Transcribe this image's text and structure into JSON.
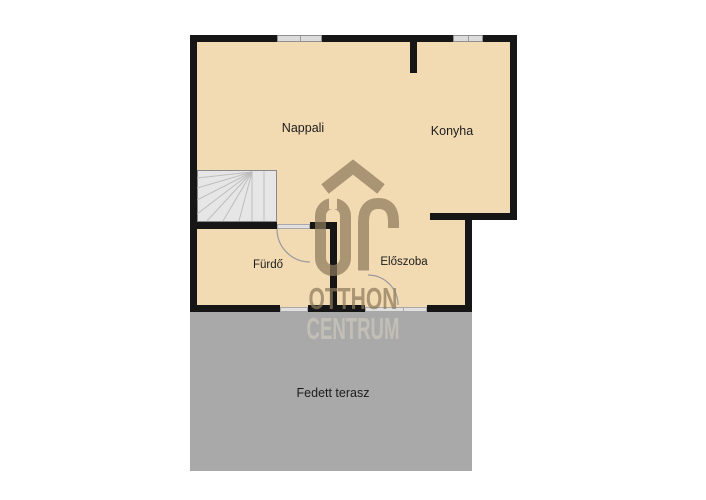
{
  "canvas": {
    "width": 706,
    "height": 500
  },
  "colors": {
    "floor": "#f2dbb3",
    "wall": "#161616",
    "terrace": "#a9a9a9",
    "stairs_fill": "#e6e6e6",
    "window_fill": "#dcdcdc",
    "watermark_tan": "#8d7b5c",
    "watermark_gray": "#c7c3b9",
    "label_text": "#1c1c1c"
  },
  "rooms": {
    "nappali": {
      "label": "Nappali"
    },
    "konyha": {
      "label": "Konyha"
    },
    "furdo": {
      "label": "Fürdő"
    },
    "eloszoba": {
      "label": "Előszoba"
    },
    "terasz": {
      "label": "Fedett terasz"
    }
  },
  "watermark": {
    "monogram": "ŐC",
    "line1": "OTTHON",
    "line2": "CENTRUM"
  }
}
